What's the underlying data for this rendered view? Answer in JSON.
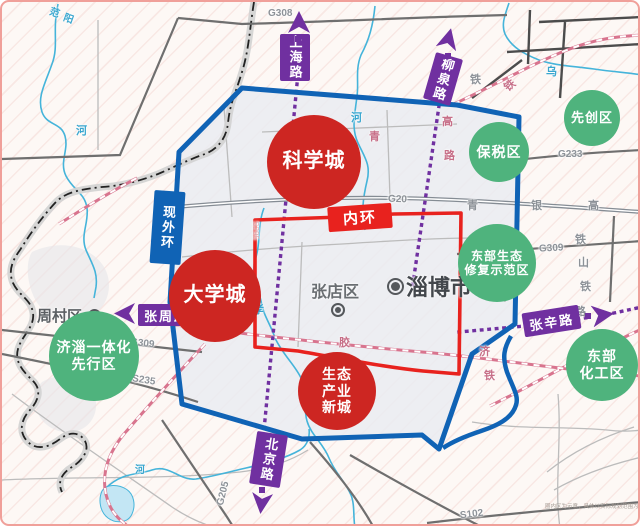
{
  "map_title": "淄博市功能区规划示意图",
  "disclaimer": "圈内区为示意，具体以实际规划范围为准。",
  "colors": {
    "red": "#cd2622",
    "green": "#4fb37d",
    "purple": "#7030a0",
    "blue": "#1063b5",
    "ring_red": "#e8221e"
  },
  "zones": [
    {
      "id": "science-city",
      "lines": [
        "科学城"
      ],
      "type": "red",
      "x": 312,
      "y": 160,
      "r": 47,
      "fs": 20
    },
    {
      "id": "university-town",
      "lines": [
        "大学城"
      ],
      "type": "red",
      "x": 213,
      "y": 294,
      "r": 46,
      "fs": 20
    },
    {
      "id": "eco-industry-new-town",
      "lines": [
        "生态",
        "产业",
        "新城"
      ],
      "type": "red",
      "x": 335,
      "y": 389,
      "r": 39,
      "fs": 14
    },
    {
      "id": "jizi-integration-pilot-zone",
      "lines": [
        "济淄一体化",
        "先行区"
      ],
      "type": "green",
      "x": 92,
      "y": 354,
      "r": 45,
      "fs": 14
    },
    {
      "id": "bonded-zone",
      "lines": [
        "保税区"
      ],
      "type": "green",
      "x": 497,
      "y": 150,
      "r": 30,
      "fs": 14
    },
    {
      "id": "pioneer-zone",
      "lines": [
        "先创区"
      ],
      "type": "green",
      "x": 590,
      "y": 116,
      "r": 28,
      "fs": 13
    },
    {
      "id": "eastern-eco-restoration-demo-zone",
      "lines": [
        "东部生态",
        "修复示范区"
      ],
      "type": "green",
      "x": 495,
      "y": 261,
      "r": 39,
      "fs": 12
    },
    {
      "id": "eastern-chemical-zone",
      "lines": [
        "东部",
        "化工区"
      ],
      "type": "green",
      "x": 600,
      "y": 363,
      "r": 36,
      "fs": 14
    }
  ],
  "signs": [
    {
      "id": "shanghai-road-sign",
      "label": "上海路",
      "dir": "v",
      "color": "purple",
      "x": 278,
      "y": 32,
      "w": 30,
      "h": 47,
      "rot": 0,
      "fs": 13
    },
    {
      "id": "liuquan-road-sign",
      "label": "柳泉路",
      "dir": "v",
      "color": "purple",
      "x": 427,
      "y": 53,
      "w": 28,
      "h": 48,
      "rot": 16,
      "fs": 13
    },
    {
      "id": "current-outer-ring-sign",
      "label": "现外环",
      "dir": "v",
      "color": "blue",
      "x": 150,
      "y": 189,
      "w": 31,
      "h": 73,
      "rot": 4,
      "fs": 13
    },
    {
      "id": "inner-ring-sign",
      "label": "内环",
      "dir": "h",
      "color": "redbg",
      "x": 326,
      "y": 203,
      "w": 64,
      "h": 25,
      "rot": -4,
      "fs": 15
    },
    {
      "id": "zhangzhou-road-sign",
      "label": "张周路",
      "dir": "h",
      "color": "purple",
      "x": 136,
      "y": 302,
      "w": 57,
      "h": 22,
      "rot": 0,
      "fs": 13
    },
    {
      "id": "zhangxin-road-sign",
      "label": "张辛路",
      "dir": "h",
      "color": "purple",
      "x": 521,
      "y": 307,
      "w": 57,
      "h": 24,
      "rot": -9,
      "fs": 13
    },
    {
      "id": "beijing-road-sign",
      "label": "北京路",
      "dir": "v",
      "color": "purple",
      "x": 251,
      "y": 431,
      "w": 31,
      "h": 53,
      "rot": 9,
      "fs": 13
    }
  ],
  "arrows": [
    {
      "id": "shanghai-road-arrow",
      "x": 286,
      "y": 9,
      "s": 22,
      "rot": 0,
      "dot": [
        293,
        34
      ]
    },
    {
      "id": "liuquan-road-arrow",
      "x": 436,
      "y": 26,
      "s": 21,
      "rot": 14,
      "dot": [
        443,
        51
      ]
    },
    {
      "id": "zhangzhou-road-arrow",
      "x": 112,
      "y": 301,
      "s": 21,
      "rot": -90,
      "dot": null
    },
    {
      "id": "zhangxin-road-arrow",
      "x": 590,
      "y": 302,
      "s": 22,
      "rot": 82,
      "dot": [
        583,
        311
      ]
    },
    {
      "id": "beijing-road-arrow",
      "x": 249,
      "y": 491,
      "s": 21,
      "rot": 186,
      "dot": [
        257,
        485
      ]
    }
  ],
  "city_labels": [
    {
      "id": "zhoucun-district",
      "label": "周村区",
      "x": 35,
      "y": 303,
      "fs": 15,
      "color": "#5b5f63",
      "marker": {
        "x": 86,
        "y": 307,
        "s": 9
      }
    },
    {
      "id": "zhangdian-district",
      "label": "张店区",
      "x": 309,
      "y": 276,
      "fs": 16,
      "color": "#6a6e72",
      "marker": {
        "x": 329,
        "y": 301,
        "s": 10
      }
    },
    {
      "id": "zibo-city",
      "label": "淄博市",
      "x": 404,
      "y": 268,
      "fs": 22,
      "color": "#43474c",
      "marker": {
        "x": 385,
        "y": 276,
        "s": 13
      }
    }
  ],
  "road_labels": [
    {
      "t": "G308",
      "x": 266,
      "y": 6,
      "rot": 0
    },
    {
      "t": "G20",
      "x": 386,
      "y": 192,
      "rot": 2
    },
    {
      "t": "G233",
      "x": 556,
      "y": 147,
      "rot": 0
    },
    {
      "t": "G309",
      "x": 537,
      "y": 241,
      "rot": -3
    },
    {
      "t": "G309",
      "x": 128,
      "y": 336,
      "rot": 7
    },
    {
      "t": "S235",
      "x": 130,
      "y": 373,
      "rot": 9
    },
    {
      "t": "G205",
      "x": 209,
      "y": 486,
      "rot": -76
    },
    {
      "t": "S102",
      "x": 458,
      "y": 507,
      "rot": -7
    },
    {
      "t": "S295",
      "x": 244,
      "y": 224,
      "rot": 90,
      "cls": "faint"
    }
  ],
  "map_chars": [
    {
      "t": "范",
      "x": 48,
      "y": 2,
      "c": "river",
      "rot": 20,
      "fs": 10
    },
    {
      "t": "阳",
      "x": 62,
      "y": 8,
      "c": "river",
      "rot": 20,
      "fs": 10
    },
    {
      "t": "河",
      "x": 74,
      "y": 120,
      "c": "river"
    },
    {
      "t": "河",
      "x": 133,
      "y": 459,
      "c": "river",
      "fs": 10
    },
    {
      "t": "河",
      "x": 349,
      "y": 107,
      "c": "river"
    },
    {
      "t": "孝",
      "x": 251,
      "y": 299,
      "c": "river"
    },
    {
      "t": "河",
      "x": 305,
      "y": 397,
      "c": "river"
    },
    {
      "t": "乌",
      "x": 544,
      "y": 61,
      "c": "river"
    },
    {
      "t": "青",
      "x": 367,
      "y": 126,
      "c": "rail"
    },
    {
      "t": "高",
      "x": 440,
      "y": 111,
      "c": "rail"
    },
    {
      "t": "路",
      "x": 442,
      "y": 145,
      "c": "rail"
    },
    {
      "t": "铁",
      "x": 502,
      "y": 75,
      "c": "rail",
      "rot": -40
    },
    {
      "t": "铁",
      "x": 468,
      "y": 69,
      "c": "gray"
    },
    {
      "t": "青",
      "x": 465,
      "y": 195,
      "c": "gray"
    },
    {
      "t": "银",
      "x": 529,
      "y": 195,
      "c": "gray"
    },
    {
      "t": "高",
      "x": 586,
      "y": 195,
      "c": "gray"
    },
    {
      "t": "铁",
      "x": 573,
      "y": 229,
      "c": "gray"
    },
    {
      "t": "山",
      "x": 576,
      "y": 252,
      "c": "gray"
    },
    {
      "t": "铁",
      "x": 578,
      "y": 276,
      "c": "gray"
    },
    {
      "t": "路",
      "x": 573,
      "y": 301,
      "c": "gray"
    },
    {
      "t": "胶",
      "x": 337,
      "y": 332,
      "c": "rail"
    },
    {
      "t": "济",
      "x": 477,
      "y": 341,
      "c": "rail"
    },
    {
      "t": "铁",
      "x": 482,
      "y": 365,
      "c": "rail"
    }
  ]
}
